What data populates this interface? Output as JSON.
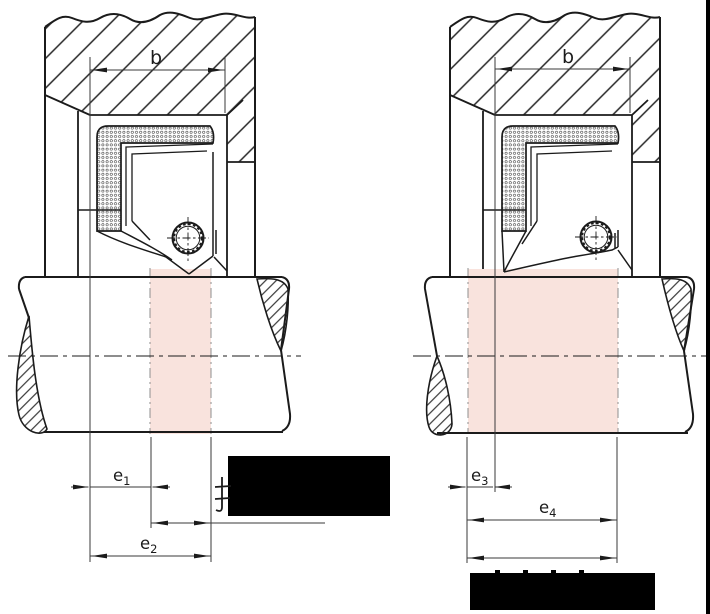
{
  "diagram": {
    "left": {
      "width_label": "b",
      "dims": [
        {
          "base": "e",
          "sub": "1"
        },
        {
          "base": "e",
          "sub": "2"
        }
      ]
    },
    "right": {
      "width_label": "b",
      "dims": [
        {
          "base": "e",
          "sub": "3"
        },
        {
          "base": "e",
          "sub": "4"
        }
      ]
    }
  },
  "colors": {
    "background": "#ffffff",
    "line": "#1b1b1b",
    "contact_zone": "#f9e3dd",
    "redaction": "#000000"
  }
}
